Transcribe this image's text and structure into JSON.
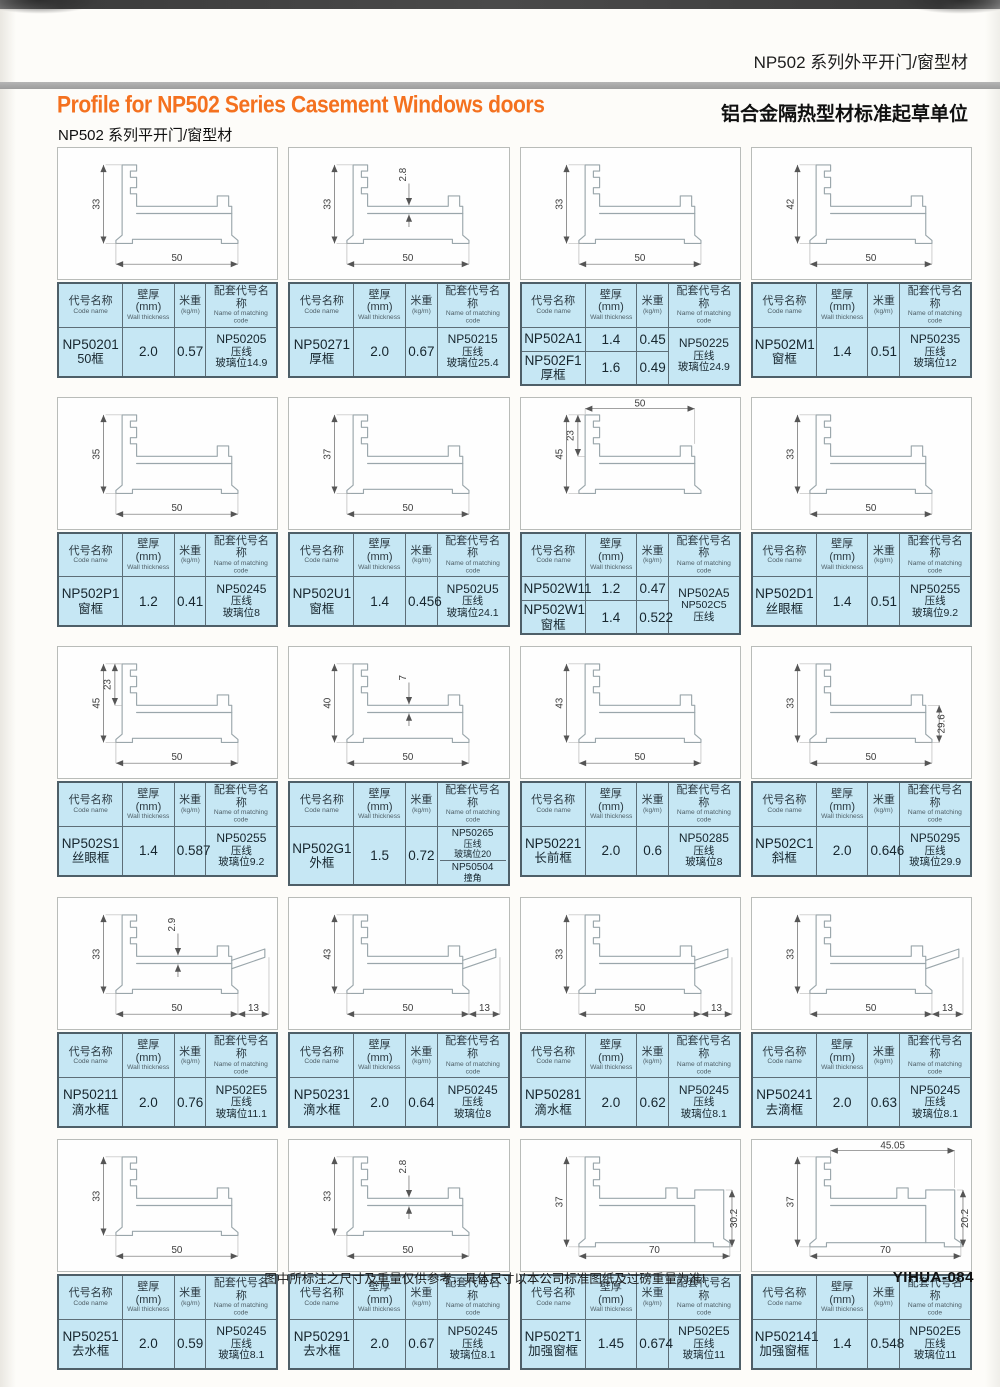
{
  "page": {
    "header_tag_cn": "NP502 系列外平开门/窗型材",
    "header_org_cn": "铝合金隔热型材标准起草单位",
    "title_en": "Profile for NP502 Series Casement Windows doors",
    "subtitle_cn": "NP502 系列平开门/窗型材",
    "footer_note": "图中所标注之尺寸及重量仅供参考，具体尺寸以本公司标准图纸及过磅重量为准!",
    "footer_code": "YIHUA-084"
  },
  "colors": {
    "accent_orange": "#f4711f",
    "table_blue": "#c6e7f4",
    "rule_gray": "#a5a5a5",
    "border_slate": "#5d6e77"
  },
  "table_headers": {
    "code_cn": "代号名称",
    "code_en": "Code name",
    "thickness_cn": "壁厚(mm)",
    "thickness_en": "Wall thickness",
    "weight_cn": "米重",
    "weight_en": "(kg/m)",
    "matching_cn": "配套代号名称",
    "matching_en": "Name of matching code"
  },
  "cells": [
    {
      "variant": "std",
      "dims": [
        {
          "v": "33",
          "pos": "left"
        },
        {
          "v": "50",
          "pos": "bottom"
        }
      ],
      "rows": [
        {
          "code": "NP50201",
          "name": "50框",
          "thickness": "2.0",
          "weight": "0.57"
        }
      ],
      "matching": [
        [
          "NP50205",
          "压线",
          "玻璃位14.9"
        ]
      ]
    },
    {
      "variant": "std",
      "dims": [
        {
          "v": "33",
          "pos": "left"
        },
        {
          "v": "2.8",
          "pos": "inner"
        },
        {
          "v": "50",
          "pos": "bottom"
        }
      ],
      "rows": [
        {
          "code": "NP50271",
          "name": "厚框",
          "thickness": "2.0",
          "weight": "0.67"
        }
      ],
      "matching": [
        [
          "NP50215",
          "压线",
          "玻璃位25.4"
        ]
      ]
    },
    {
      "variant": "std",
      "dims": [
        {
          "v": "33",
          "pos": "left"
        },
        {
          "v": "50",
          "pos": "bottom"
        }
      ],
      "rows": [
        {
          "code": "NP502A1",
          "name": "",
          "thickness": "1.4",
          "weight": "0.45"
        },
        {
          "code": "NP502F1",
          "name": "厚框",
          "thickness": "1.6",
          "weight": "0.49"
        }
      ],
      "matching": [
        [
          "NP50225",
          "压线",
          "玻璃位24.9"
        ]
      ]
    },
    {
      "variant": "std",
      "dims": [
        {
          "v": "42",
          "pos": "left"
        },
        {
          "v": "50",
          "pos": "bottom"
        }
      ],
      "rows": [
        {
          "code": "NP502M1",
          "name": "窗框",
          "thickness": "1.4",
          "weight": "0.51"
        }
      ],
      "matching": [
        [
          "NP50235",
          "压线",
          "玻璃位12"
        ]
      ]
    },
    {
      "variant": "std",
      "dims": [
        {
          "v": "35",
          "pos": "left"
        },
        {
          "v": "50",
          "pos": "bottom"
        }
      ],
      "rows": [
        {
          "code": "NP502P1",
          "name": "窗框",
          "thickness": "1.2",
          "weight": "0.41"
        }
      ],
      "matching": [
        [
          "NP50245",
          "压线",
          "玻璃位8"
        ]
      ]
    },
    {
      "variant": "std",
      "dims": [
        {
          "v": "37",
          "pos": "left"
        },
        {
          "v": "50",
          "pos": "bottom"
        }
      ],
      "rows": [
        {
          "code": "NP502U1",
          "name": "窗框",
          "thickness": "1.4",
          "weight": "0.456"
        }
      ],
      "matching": [
        [
          "NP502U5",
          "压线",
          "玻璃位24.1"
        ]
      ]
    },
    {
      "variant": "std",
      "dims": [
        {
          "v": "50",
          "pos": "top"
        },
        {
          "v": "23",
          "pos": "inner-left"
        },
        {
          "v": "45",
          "pos": "left"
        }
      ],
      "rows": [
        {
          "code": "NP502W11",
          "name": "",
          "thickness": "1.2",
          "weight": "0.47"
        },
        {
          "code": "NP502W1",
          "name": "窗框",
          "thickness": "1.4",
          "weight": "0.522"
        }
      ],
      "matching": [
        [
          "NP502A5",
          "NP502C5",
          "压线"
        ]
      ]
    },
    {
      "variant": "std",
      "dims": [
        {
          "v": "33",
          "pos": "left"
        },
        {
          "v": "50",
          "pos": "bottom"
        }
      ],
      "rows": [
        {
          "code": "NP502D1",
          "name": "丝眼框",
          "thickness": "1.4",
          "weight": "0.51"
        }
      ],
      "matching": [
        [
          "NP50255",
          "压线",
          "玻璃位9.2"
        ]
      ]
    },
    {
      "variant": "std",
      "dims": [
        {
          "v": "45",
          "pos": "left"
        },
        {
          "v": "23",
          "pos": "inner-left"
        },
        {
          "v": "50",
          "pos": "bottom"
        }
      ],
      "rows": [
        {
          "code": "NP502S1",
          "name": "丝眼框",
          "thickness": "1.4",
          "weight": "0.587"
        }
      ],
      "matching": [
        [
          "NP50255",
          "压线",
          "玻璃位9.2"
        ]
      ]
    },
    {
      "variant": "std",
      "dims": [
        {
          "v": "40",
          "pos": "left"
        },
        {
          "v": "7",
          "pos": "inner"
        },
        {
          "v": "50",
          "pos": "bottom"
        }
      ],
      "rows": [
        {
          "code": "NP502G1",
          "name": "外框",
          "thickness": "1.5",
          "weight": "0.72"
        }
      ],
      "matching": [
        [
          "NP50265",
          "压线",
          "玻璃位20"
        ],
        [
          "NP50504",
          "撞角"
        ]
      ]
    },
    {
      "variant": "std",
      "dims": [
        {
          "v": "43",
          "pos": "left"
        },
        {
          "v": "50",
          "pos": "bottom"
        }
      ],
      "rows": [
        {
          "code": "NP50221",
          "name": "长前框",
          "thickness": "2.0",
          "weight": "0.6"
        }
      ],
      "matching": [
        [
          "NP50285",
          "压线",
          "玻璃位8"
        ]
      ]
    },
    {
      "variant": "std",
      "dims": [
        {
          "v": "33",
          "pos": "left"
        },
        {
          "v": "29.6",
          "pos": "right"
        },
        {
          "v": "50",
          "pos": "bottom"
        }
      ],
      "rows": [
        {
          "code": "NP502C1",
          "name": "斜框",
          "thickness": "2.0",
          "weight": "0.646"
        }
      ],
      "matching": [
        [
          "NP50295",
          "压线",
          "玻璃位29.9"
        ]
      ]
    },
    {
      "variant": "std",
      "dims": [
        {
          "v": "33",
          "pos": "left"
        },
        {
          "v": "2.9",
          "pos": "inner"
        },
        {
          "v": "50",
          "pos": "bottom"
        },
        {
          "v": "13",
          "pos": "bottom-right"
        }
      ],
      "rows": [
        {
          "code": "NP50211",
          "name": "滴水框",
          "thickness": "2.0",
          "weight": "0.76"
        }
      ],
      "matching": [
        [
          "NP502E5",
          "压线",
          "玻璃位11.1"
        ]
      ]
    },
    {
      "variant": "std",
      "dims": [
        {
          "v": "43",
          "pos": "left"
        },
        {
          "v": "50",
          "pos": "bottom"
        },
        {
          "v": "13",
          "pos": "bottom-right"
        }
      ],
      "rows": [
        {
          "code": "NP50231",
          "name": "滴水框",
          "thickness": "2.0",
          "weight": "0.64"
        }
      ],
      "matching": [
        [
          "NP50245",
          "压线",
          "玻璃位8"
        ]
      ]
    },
    {
      "variant": "std",
      "dims": [
        {
          "v": "33",
          "pos": "left"
        },
        {
          "v": "50",
          "pos": "bottom"
        },
        {
          "v": "13",
          "pos": "bottom-right"
        }
      ],
      "rows": [
        {
          "code": "NP50281",
          "name": "滴水框",
          "thickness": "2.0",
          "weight": "0.62"
        }
      ],
      "matching": [
        [
          "NP50245",
          "压线",
          "玻璃位8.1"
        ]
      ]
    },
    {
      "variant": "std",
      "dims": [
        {
          "v": "33",
          "pos": "left"
        },
        {
          "v": "50",
          "pos": "bottom"
        },
        {
          "v": "13",
          "pos": "bottom-right"
        }
      ],
      "rows": [
        {
          "code": "NP50241",
          "name": "去滴框",
          "thickness": "2.0",
          "weight": "0.63"
        }
      ],
      "matching": [
        [
          "NP50245",
          "压线",
          "玻璃位8.1"
        ]
      ]
    },
    {
      "variant": "std",
      "dims": [
        {
          "v": "33",
          "pos": "left"
        },
        {
          "v": "50",
          "pos": "bottom"
        }
      ],
      "rows": [
        {
          "code": "NP50251",
          "name": "去水框",
          "thickness": "2.0",
          "weight": "0.59"
        }
      ],
      "matching": [
        [
          "NP50245",
          "压线",
          "玻璃位8.1"
        ]
      ]
    },
    {
      "variant": "std",
      "dims": [
        {
          "v": "33",
          "pos": "left"
        },
        {
          "v": "2.8",
          "pos": "inner"
        },
        {
          "v": "50",
          "pos": "bottom"
        }
      ],
      "rows": [
        {
          "code": "NP50291",
          "name": "去水框",
          "thickness": "2.0",
          "weight": "0.67"
        }
      ],
      "matching": [
        [
          "NP50245",
          "压线",
          "玻璃位8.1"
        ]
      ]
    },
    {
      "variant": "wide",
      "dims": [
        {
          "v": "37",
          "pos": "left"
        },
        {
          "v": "30.2",
          "pos": "right"
        },
        {
          "v": "70",
          "pos": "bottom"
        }
      ],
      "rows": [
        {
          "code": "NP502T1",
          "name": "加强窗框",
          "thickness": "1.45",
          "weight": "0.674"
        }
      ],
      "matching": [
        [
          "NP502E5",
          "压线",
          "玻璃位11"
        ]
      ]
    },
    {
      "variant": "wide",
      "dims": [
        {
          "v": "37",
          "pos": "left"
        },
        {
          "v": "45.05",
          "pos": "top"
        },
        {
          "v": "20.2",
          "pos": "right"
        },
        {
          "v": "70",
          "pos": "bottom"
        }
      ],
      "rows": [
        {
          "code": "NP502141",
          "name": "加强窗框",
          "thickness": "1.4",
          "weight": "0.548"
        }
      ],
      "matching": [
        [
          "NP502E5",
          "压线",
          "玻璃位11"
        ]
      ]
    }
  ]
}
